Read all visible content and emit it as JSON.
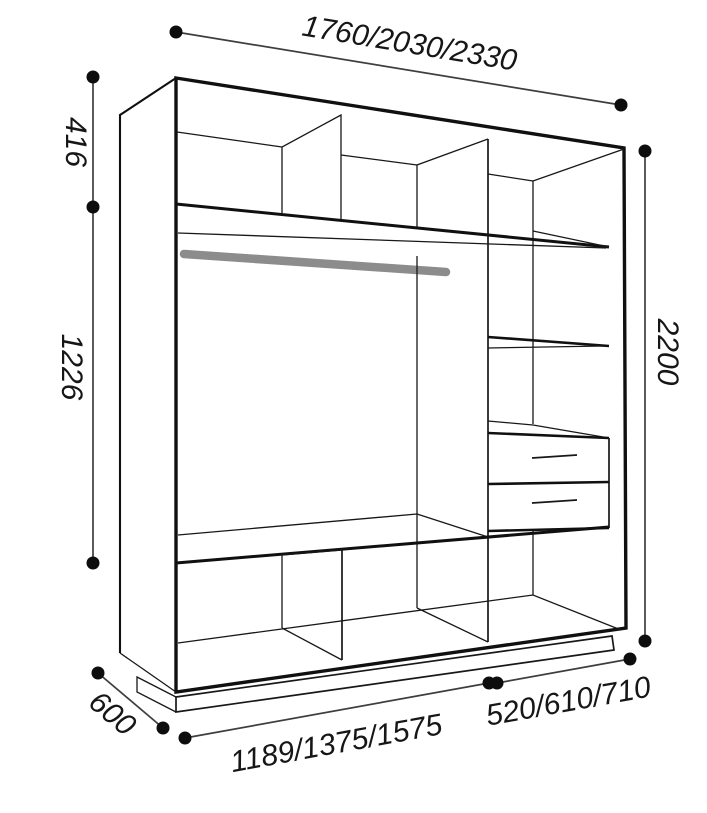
{
  "diagram": {
    "type": "wardrobe-technical-drawing",
    "dimensions": {
      "overall_width": "1760/2030/2330",
      "upper_section_height": "416",
      "middle_section_height": "1226",
      "overall_height": "2200",
      "depth": "600",
      "lower_width": "1189/1375/1575",
      "right_section_width": "520/610/710"
    },
    "parts": [
      "top-shelf-row-with-dividers",
      "hanging-rod",
      "center-partition",
      "right-column-shelves",
      "two-drawers",
      "bottom-shelf-row-with-dividers",
      "plinth-base"
    ],
    "colors": {
      "outline": "#101010",
      "dimension_line": "#3e3e3e",
      "dimension_dot": "#0d0d0d",
      "hanging_rod": "#8c8c8c",
      "background": "#ffffff"
    }
  }
}
